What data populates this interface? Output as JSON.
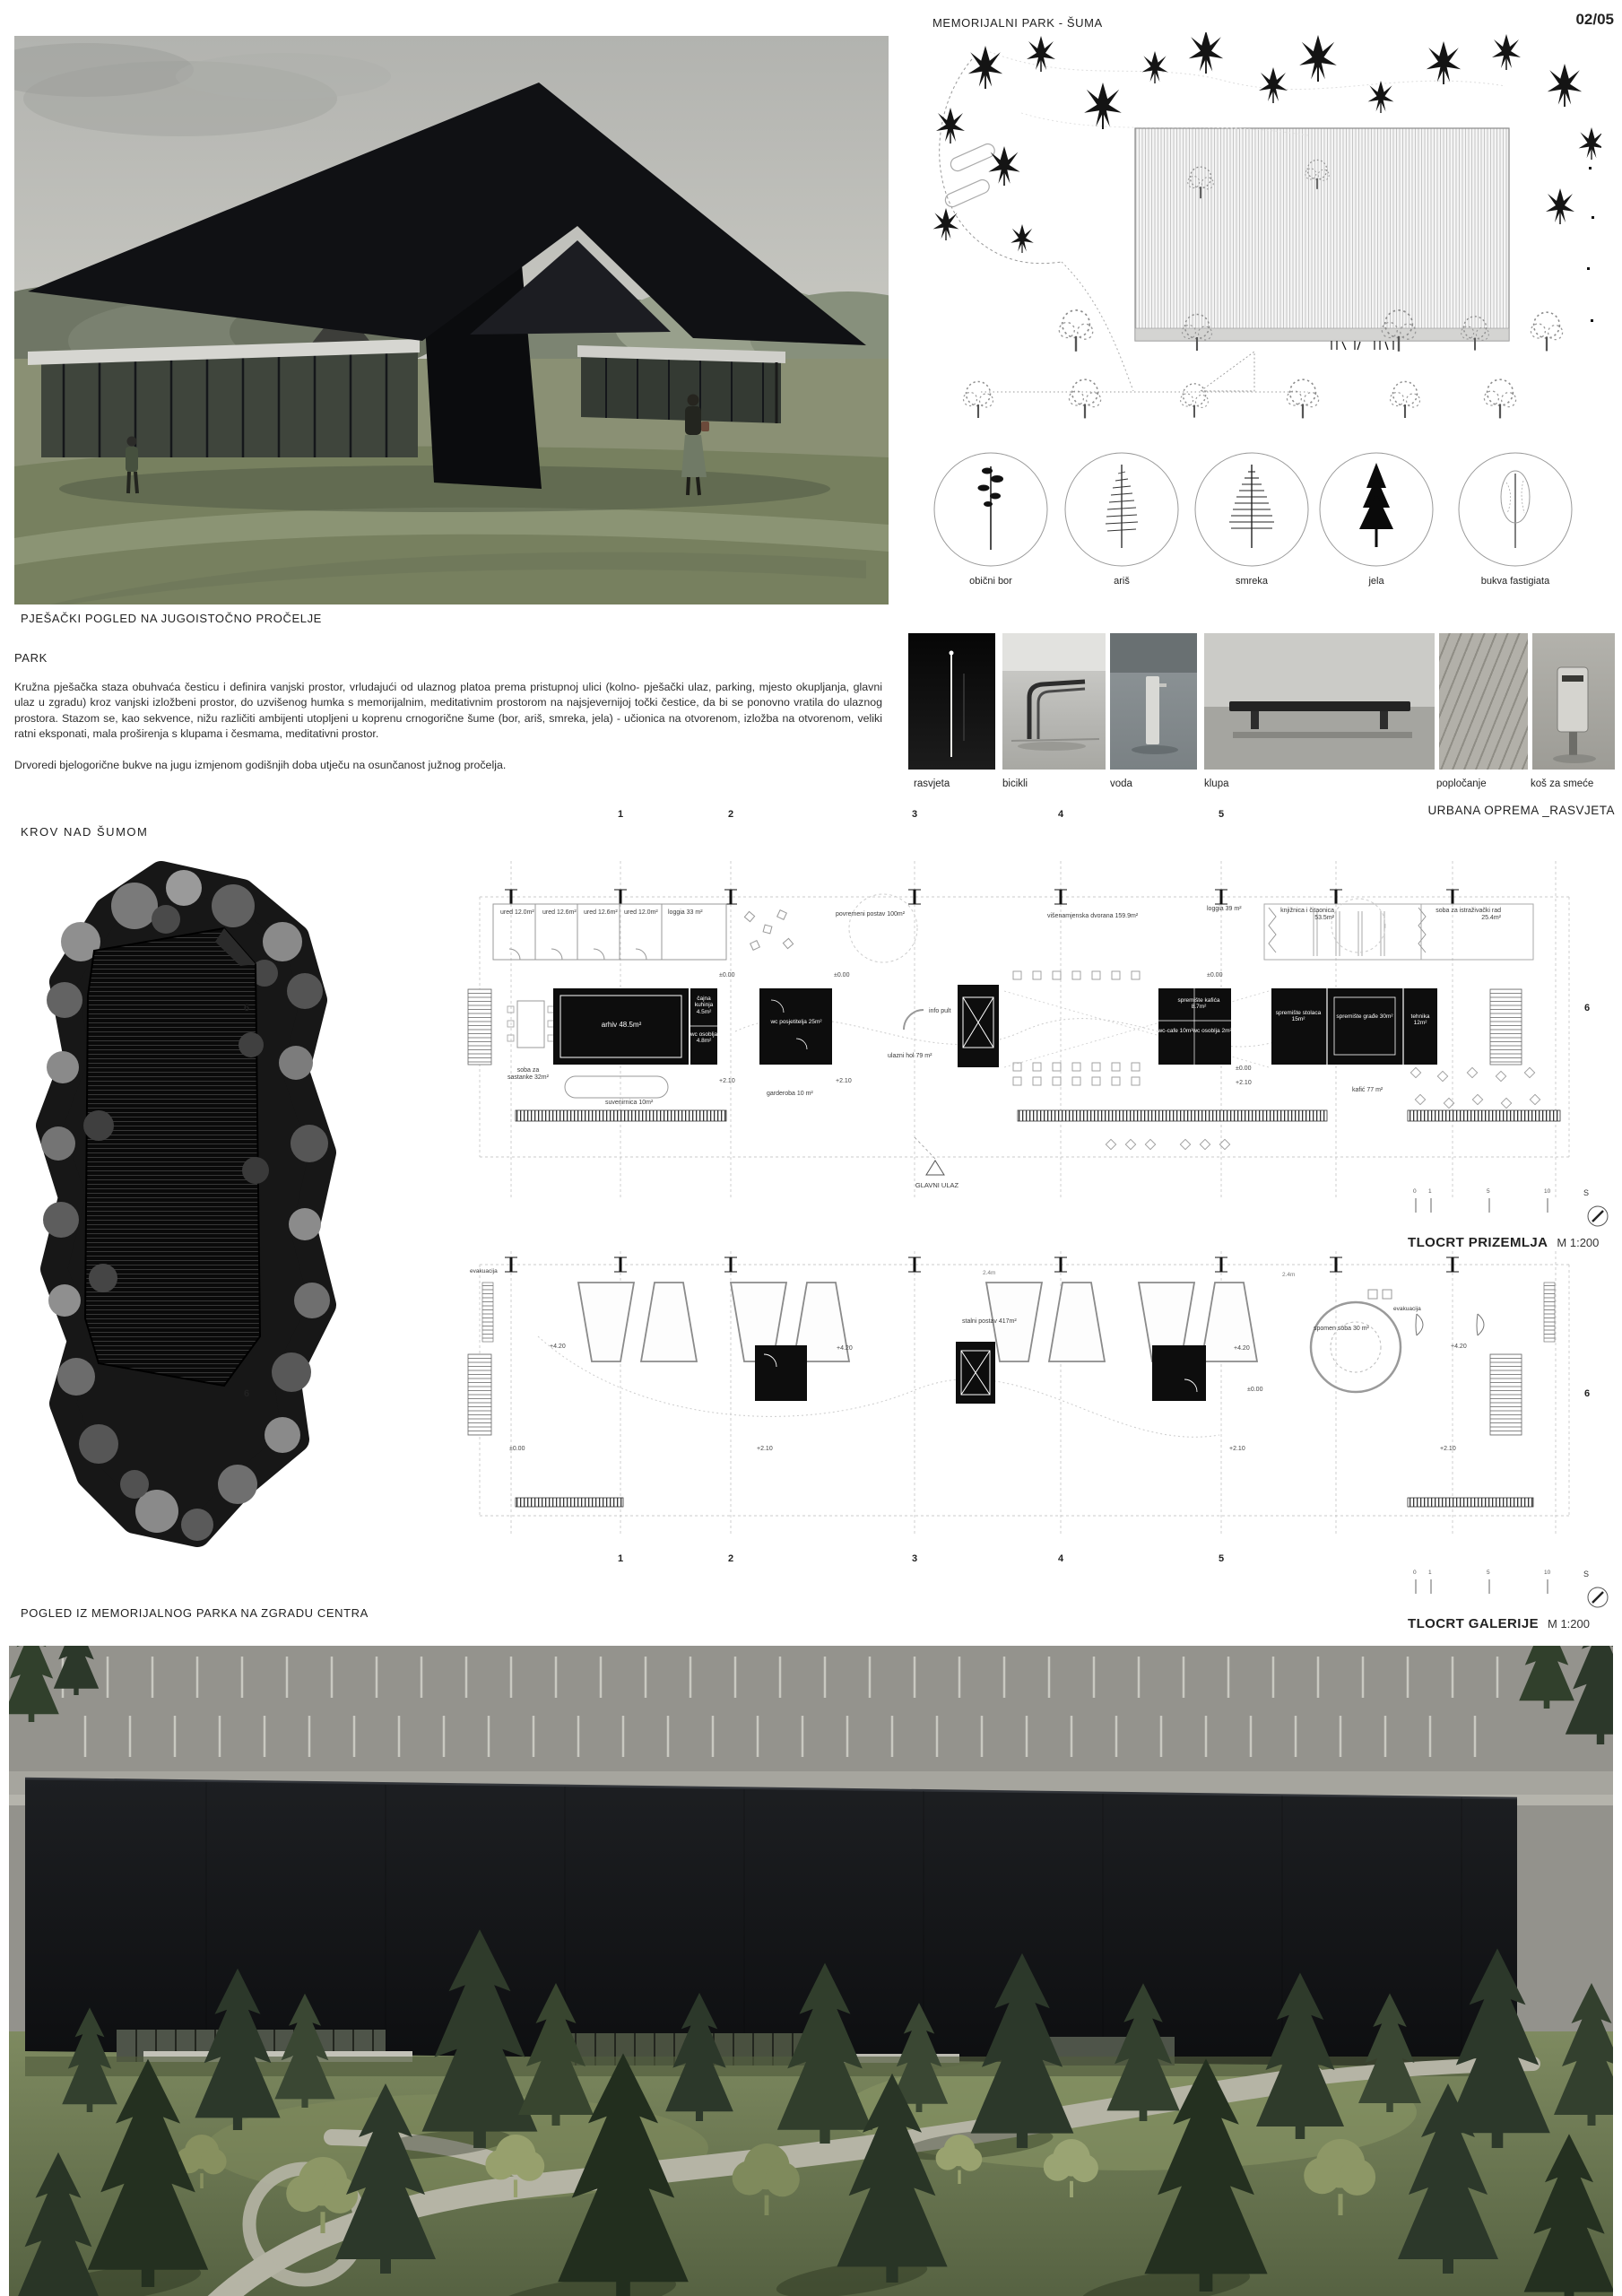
{
  "page": {
    "number": "02/05"
  },
  "site_plan": {
    "title": "MEMORIJALNI PARK - ŠUMA"
  },
  "captions": {
    "top_render": "PJEŠAČKI POGLED NA JUGOISTOČNO PROČELJE",
    "roof_plan": "KROV NAD ŠUMOM",
    "bottom_render": "POGLED IZ MEMORIJALNOG PARKA NA ZGRADU CENTRA"
  },
  "park": {
    "heading": "PARK",
    "paragraph1": "Kružna pješačka staza obuhvaća česticu i definira vanjski prostor, vrludajući od ulaznog platoa prema pristupnoj ulici (kolno- pješački ulaz, parking, mjesto okupljanja, glavni ulaz u zgradu) kroz vanjski izložbeni prostor, do uzvišenog humka s memorijalnim, meditativnim prostorom na najsjevernijoj točki čestice, da bi se ponovno vratila do ulaznog prostora. Stazom se, kao sekvence, nižu različiti ambijenti utopljeni u koprenu crnogorične šume (bor, ariš, smreka, jela) - učionica na otvorenom, izložba na otvorenom, veliki ratni eksponati, mala proširenja s klupama i česmama, meditativni prostor.",
    "paragraph2": "Drvoredi bjelogorične bukve na jugu izmjenom godišnjih doba utječu na osunčanost južnog pročelja."
  },
  "tree_legend": [
    "obični bor",
    "ariš",
    "smreka",
    "jela",
    "bukva fastigiata"
  ],
  "equipment": {
    "labels": [
      "rasvjeta",
      "bicikli",
      "voda",
      "klupa",
      "popločanje",
      "koš za smeće"
    ],
    "caption": "URBANA OPREMA _RASVJETA"
  },
  "ground_plan": {
    "title": "TLOCRT PRIZEMLJA",
    "scale": "M 1:200",
    "grid_cols": [
      "1",
      "2",
      "3",
      "4",
      "5"
    ],
    "grid_row": "6",
    "entrance": "GLAVNI ULAZ",
    "rooms": {
      "ured1": "ured 12.0m²",
      "ured2": "ured 12.6m²",
      "ured3": "ured 12.6m²",
      "ured4": "ured 12.0m²",
      "loggia_l": "loggia 33 m²",
      "povremeni": "povremeni postav 100m²",
      "dvorana": "višenamjenska dvorana 159.9m²",
      "loggia_r": "loggia 39 m²",
      "knjiznica": "knjižnica i čitaonica 53.5m²",
      "istrazivacki": "soba za istraživački rad 25.4m²",
      "arhiv": "arhiv 48.5m²",
      "cajna_kuhinja": "čajna kuhinja 4.5m²",
      "wc_osoblja_a": "wc osoblja 4.8m²",
      "sastanke": "soba za sastanke 32m²",
      "suvenirnica": "suvenirnica 10m²",
      "wc_posjetitelja": "wc posjetitelja 25m²",
      "garderoba": "garderoba 10 m²",
      "info_pult": "info pult",
      "ulazni_hol": "ulazni hol 79 m²",
      "wc_cafe": "wc-cafe 10m²",
      "wc_osoblja_b": "wc osoblja 2m²",
      "spremiste_kafica": "spremište kafića 8.7m²",
      "spremiste_stolaca": "spremište stolaca 15m²",
      "spremiste_grade": "spremište građe 30m²",
      "tehnika": "tehnika 12m²",
      "kafic": "kafić 77 m²"
    },
    "levels": {
      "zero": "±0.00",
      "plus210": "+2.10"
    }
  },
  "gallery_plan": {
    "title": "TLOCRT GALERIJE",
    "scale": "M 1:200",
    "grid_cols": [
      "1",
      "2",
      "3",
      "4",
      "5"
    ],
    "grid_row": "6",
    "rooms": {
      "stalni": "stalni postav 417m²",
      "spomen": "spomen soba 30 m²",
      "evakuacija": "evakuacija",
      "clearance": "2.4m"
    },
    "levels": {
      "zero": "±0.00",
      "plus210": "+2.10",
      "plus420": "+4.20"
    }
  },
  "scalebar": {
    "ticks": [
      "0",
      "1",
      "5",
      "10"
    ]
  },
  "compass": {
    "label": "S"
  }
}
